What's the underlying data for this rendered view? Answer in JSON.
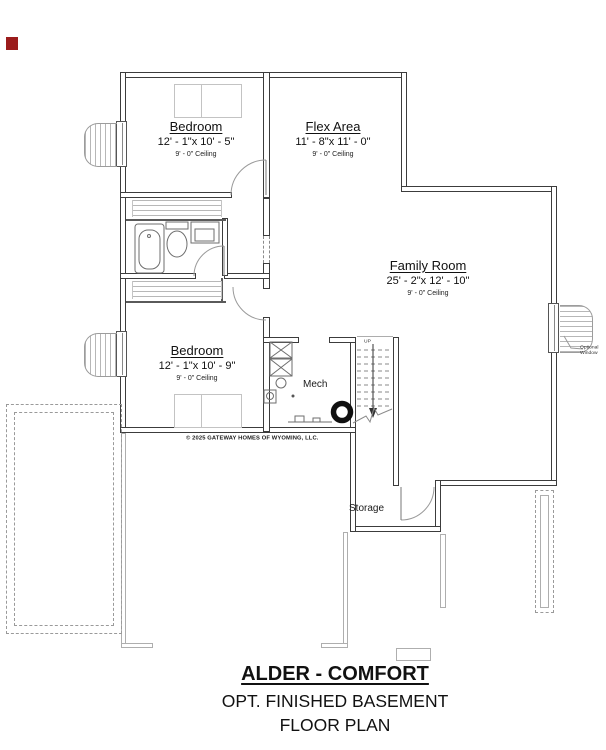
{
  "colors": {
    "wall": "#3c3c3c",
    "light_wall": "#aeaeae",
    "corner_marker": "#9b1c1c"
  },
  "rooms": {
    "bedroom1": {
      "name": "Bedroom",
      "dims": "12' - 1\"x 10' - 5\"",
      "ceiling": "9' - 0\" Ceiling"
    },
    "flex_area": {
      "name": "Flex Area",
      "dims": "11' - 8\"x 11' - 0\"",
      "ceiling": "9' - 0\" Ceiling"
    },
    "family_room": {
      "name": "Family Room",
      "dims": "25' - 2\"x 12' - 10\"",
      "ceiling": "9' - 0\" Ceiling"
    },
    "bedroom2": {
      "name": "Bedroom",
      "dims": "12' - 1\"x 10' - 9\"",
      "ceiling": "9' - 0\" Ceiling"
    },
    "mech": {
      "name": "Mech"
    },
    "storage": {
      "name": "Storage"
    }
  },
  "annotations": {
    "stairs_direction": "UP",
    "optional_window": "Optional Window",
    "copyright": "© 2025 GATEWAY HOMES OF WYOMING, LLC."
  },
  "title_block": {
    "plan_name": "ALDER - COMFORT",
    "subtitle": "OPT. FINISHED BASEMENT",
    "type": "FLOOR PLAN"
  }
}
